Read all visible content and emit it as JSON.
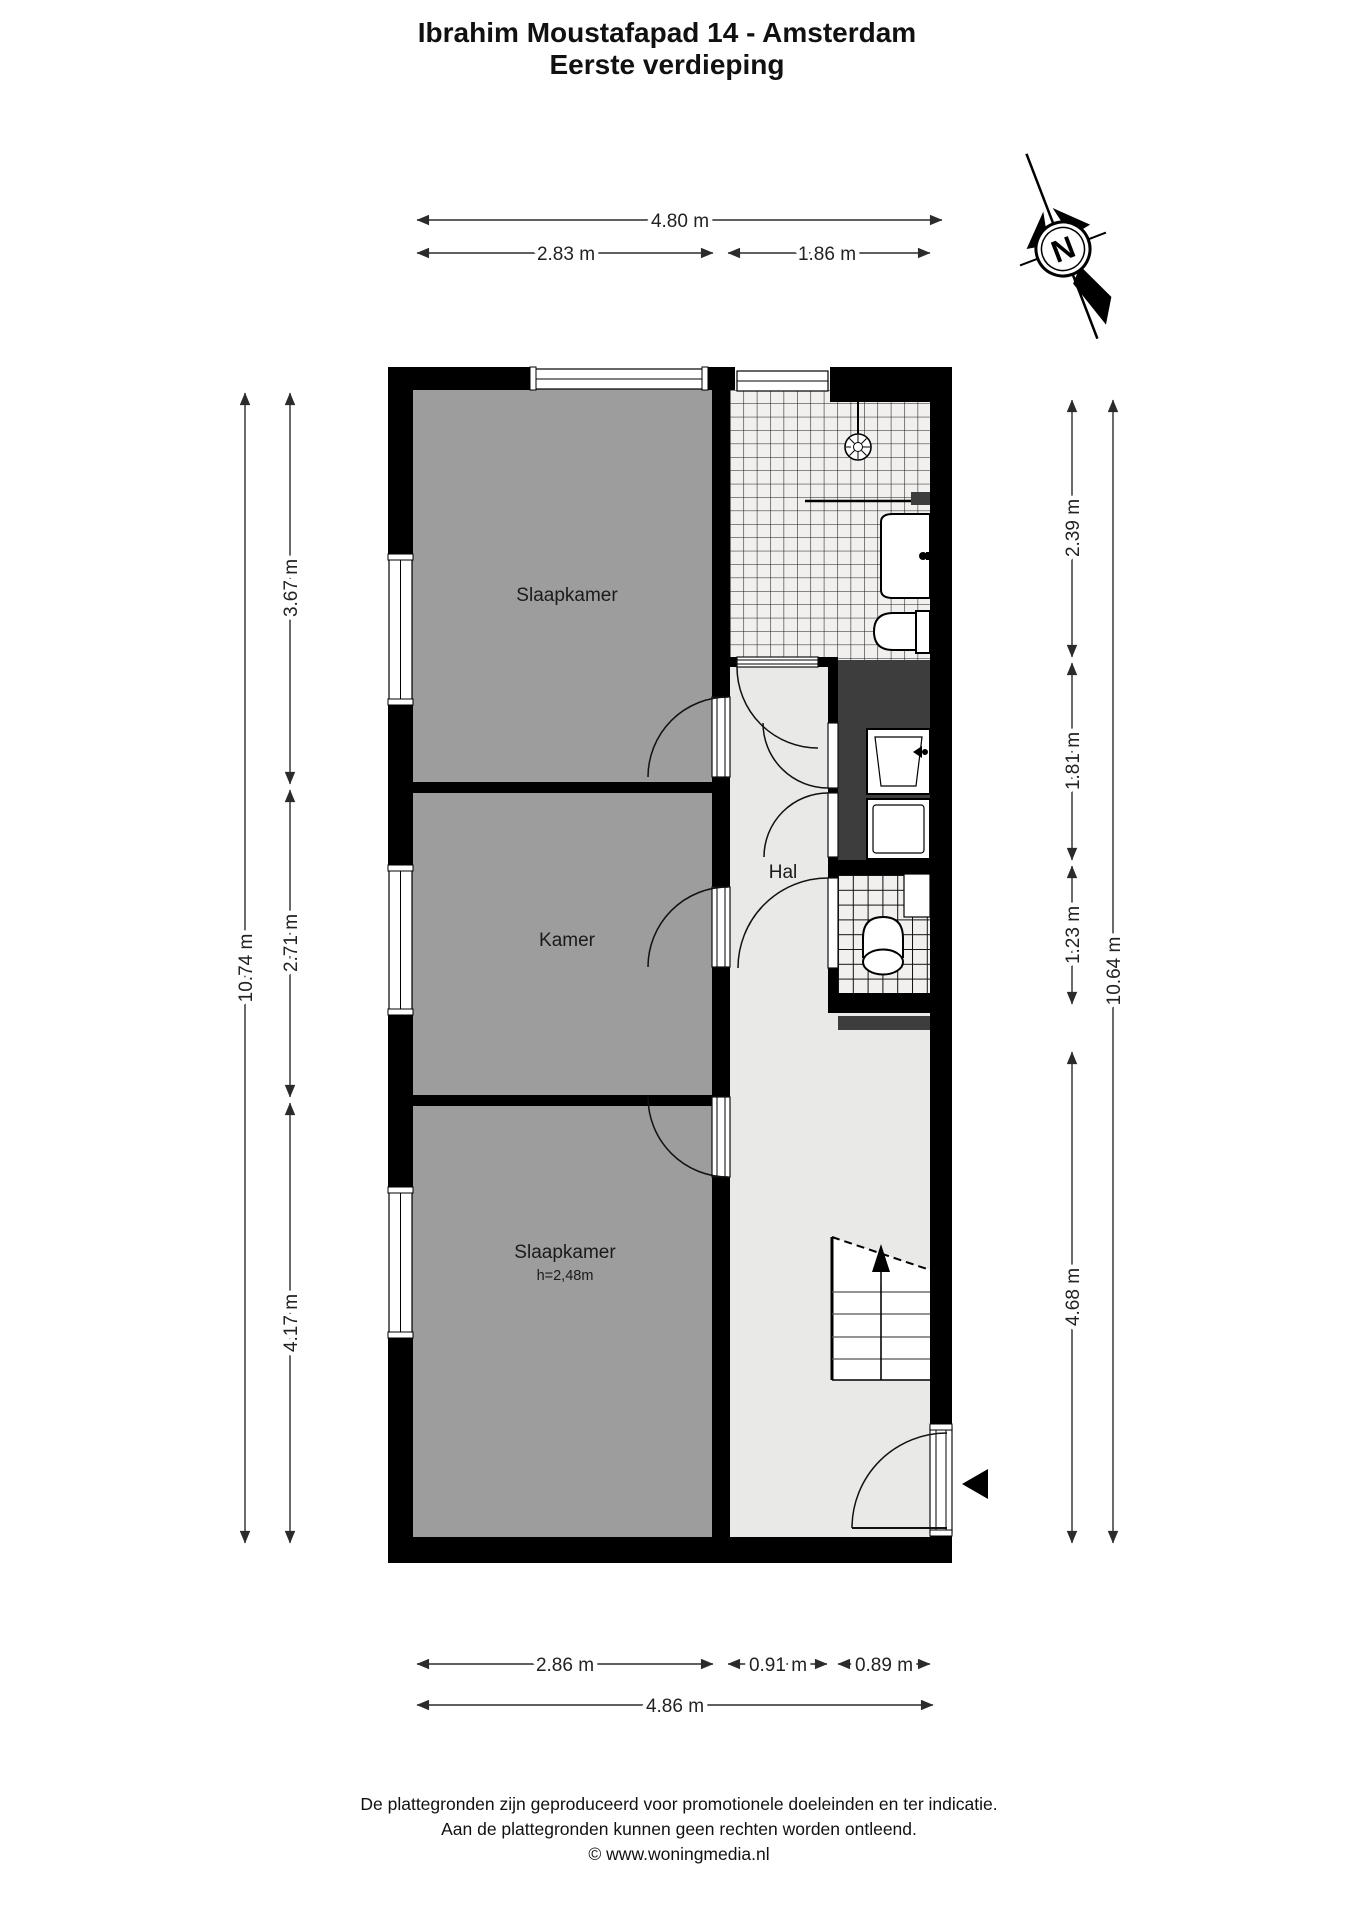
{
  "title": {
    "line1": "Ibrahim Moustafapad 14 - Amsterdam",
    "line2": "Eerste verdieping"
  },
  "compass": {
    "label": "N"
  },
  "plan": {
    "rooms": {
      "bedroom_top": {
        "label": "Slaapkamer"
      },
      "kamer": {
        "label": "Kamer"
      },
      "hall": {
        "label": "Hal"
      },
      "bedroom_bottom": {
        "label": "Slaapkamer",
        "ceiling_height": "h=2,48m"
      }
    }
  },
  "dimensions": {
    "top_total": "4.80 m",
    "top_left": "2.83 m",
    "top_right": "1.86 m",
    "bottom_left": "2.86 m",
    "bottom_mid": "0.91 m",
    "bottom_right": "0.89 m",
    "bottom_total": "4.86 m",
    "left_total": "10.74 m",
    "left_seg_0": "3.67 m",
    "left_seg_1": "2.71 m",
    "left_seg_2": "4.17 m",
    "right_total": "10.64 m",
    "right_seg_0": "2.39 m",
    "right_seg_1": "1.81 m",
    "right_seg_2": "1.23 m",
    "right_seg_3": "4.68 m"
  },
  "footer": {
    "line1": "De plattegronden zijn geproduceerd voor promotionele doeleinden en ter indicatie.",
    "line2": "Aan de plattegronden kunnen geen rechten worden ontleend.",
    "line3": "© www.woningmedia.nl"
  },
  "colors": {
    "room_fill": "#9d9d9d",
    "hall_fill": "#e9e9e7",
    "closet_fill": "#3d3d3d",
    "wall": "#000000",
    "tile_bg": "#f1f0ee"
  }
}
